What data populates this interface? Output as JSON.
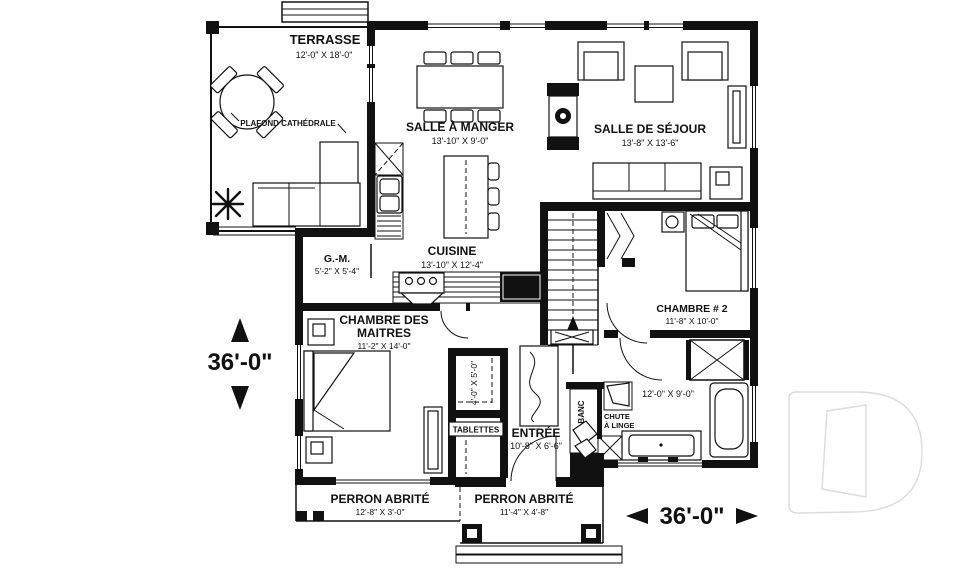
{
  "figure_type": "house-floor-plan",
  "rooms": {
    "terrasse": {
      "name": "TERRASSE",
      "dims": "12'-0\" X 18'-0\""
    },
    "manger": {
      "name": "SALLE À MANGER",
      "dims": "13'-10\" X 9'-0\""
    },
    "sejour": {
      "name": "SALLE DE SÉJOUR",
      "dims": "13'-8\" X 13'-6\""
    },
    "cuisine": {
      "name": "CUISINE",
      "dims": "13'-10\" X 12'-4\""
    },
    "gm": {
      "name": "G.-M.",
      "dims": "5'-2\" X 5'-4\""
    },
    "maitres": {
      "line1": "CHAMBRE DES",
      "line2": "MAITRES",
      "dims": "11'-2\" X 14'-0\""
    },
    "chambre2": {
      "name": "CHAMBRE # 2",
      "dims": "11'-8\" X 10'-0\""
    },
    "entree": {
      "name": "ENTRÉE",
      "dims": "10'-8\" X 6'-6\""
    },
    "walkin": {
      "dims": "4'-0\" X 5'-0\""
    },
    "bain": {
      "dims": "12'-0\" X 9'-0\""
    },
    "perron_left": {
      "name": "PERRON ABRITÉ",
      "dims": "12'-8\" X 3'-0\""
    },
    "perron_right": {
      "name": "PERRON ABRITÉ",
      "dims": "11'-4\" X 4'-8\""
    }
  },
  "annotations": {
    "plafond": "PLAFOND CATHÉDRALE",
    "tablettes": "TABLETTES",
    "banc": "BANC",
    "chute_line1": "CHUTE",
    "chute_line2": "À LINGE"
  },
  "overall": {
    "width_label": "36'-0\"",
    "depth_label": "36'-0\""
  },
  "colors": {
    "line": "#111111",
    "background": "#ffffff",
    "watermark": "#dcdcdc"
  }
}
